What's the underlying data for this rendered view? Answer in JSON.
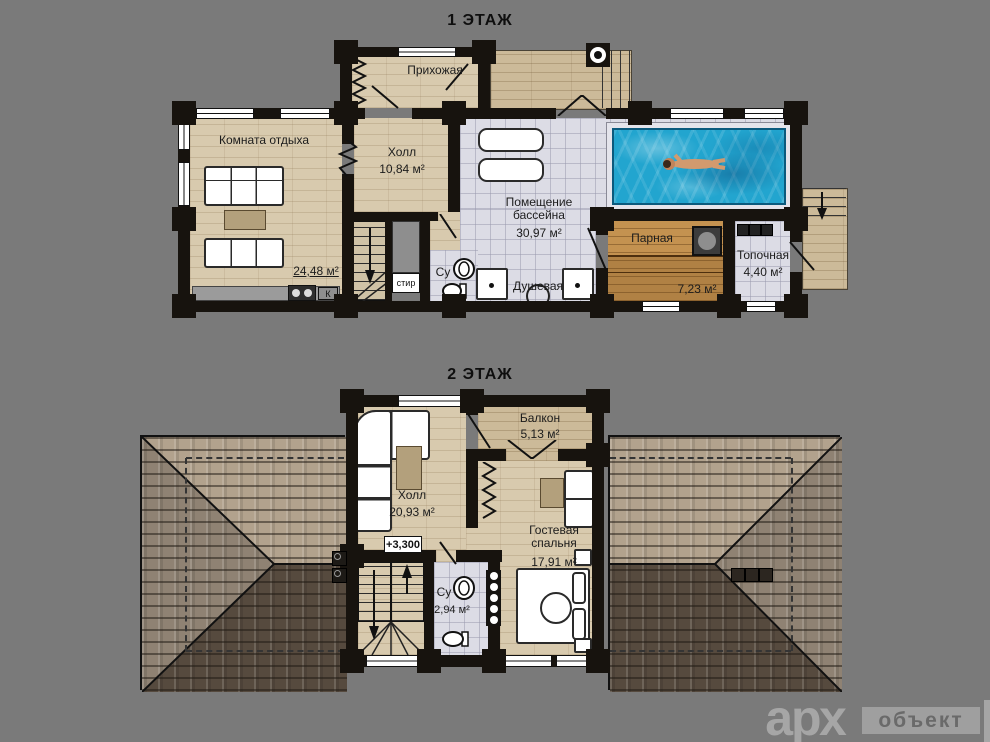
{
  "floor1": {
    "title": "1 ЭТАЖ",
    "rooms": {
      "hallway": {
        "name": "Прихожая"
      },
      "lounge": {
        "name": "Комната отдыха",
        "area": "24,48 м²"
      },
      "hall": {
        "name": "Холл",
        "area": "10,84 м²"
      },
      "pool": {
        "name": "Помещение бассейна",
        "area": "30,97 м²"
      },
      "steam": {
        "name": "Парная",
        "area": "7,23 м²"
      },
      "boiler": {
        "name": "Топочная",
        "area": "4,40 м²"
      },
      "shower": {
        "name": "Душевая"
      },
      "wc": {
        "name": "Су"
      }
    },
    "labels": {
      "washer": "стир",
      "kitchen_vent": "К"
    }
  },
  "floor2": {
    "title": "2 ЭТАЖ",
    "rooms": {
      "balcony": {
        "name": "Балкон",
        "area": "5,13 м²"
      },
      "hall": {
        "name": "Холл",
        "area": "20,93 м²"
      },
      "guest_bedroom": {
        "name": "Гостевая спальня",
        "area": "17,91 м²"
      },
      "wc": {
        "name": "Су",
        "area": "2,94 м²"
      }
    },
    "elevation_mark": "+3,300"
  },
  "logo": {
    "text_primary": "арх",
    "text_secondary": "объект"
  },
  "colors": {
    "background": "#7a7a7a",
    "walls": "#17130e",
    "wood_floor": "#d8caae",
    "tile_floor": "#dcdce5",
    "sauna_wood": "#c49250",
    "pool_water": "#22a5cf",
    "roof_light": "#b2a28d",
    "roof_dark": "#564a3e",
    "logo_gray": "#a6a6a6"
  }
}
